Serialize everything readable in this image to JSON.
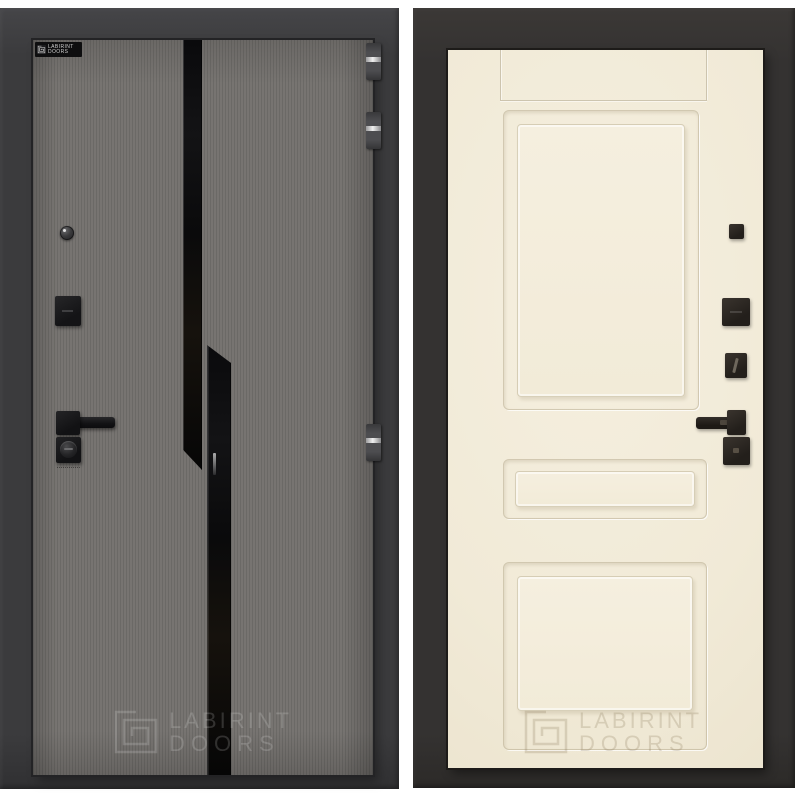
{
  "image": {
    "type": "door-product-photo-collage",
    "brand": "LABIRINT DOORS"
  },
  "left_door": {
    "badge": {
      "brand": "LABIRINT",
      "suffix": "DOORS"
    },
    "watermark": {
      "brand": "LABIRINT",
      "suffix": "DOORS"
    },
    "colors": {
      "frame": "#3b3b3d",
      "leaf": "#747270",
      "leaf_stripe": "#6b6966",
      "glass_strip": "#0b0b0d",
      "hardware": "#1a1a1c",
      "hinge": "#4d4d50",
      "hinge_pin": "#efefef"
    }
  },
  "right_door": {
    "watermark": {
      "brand": "LABIRINT",
      "suffix": "DOORS"
    },
    "colors": {
      "frame": "#343231",
      "leaf": "#f1ead7",
      "panel_line": "#d8cdb3",
      "hardware": "#2b2622"
    }
  }
}
